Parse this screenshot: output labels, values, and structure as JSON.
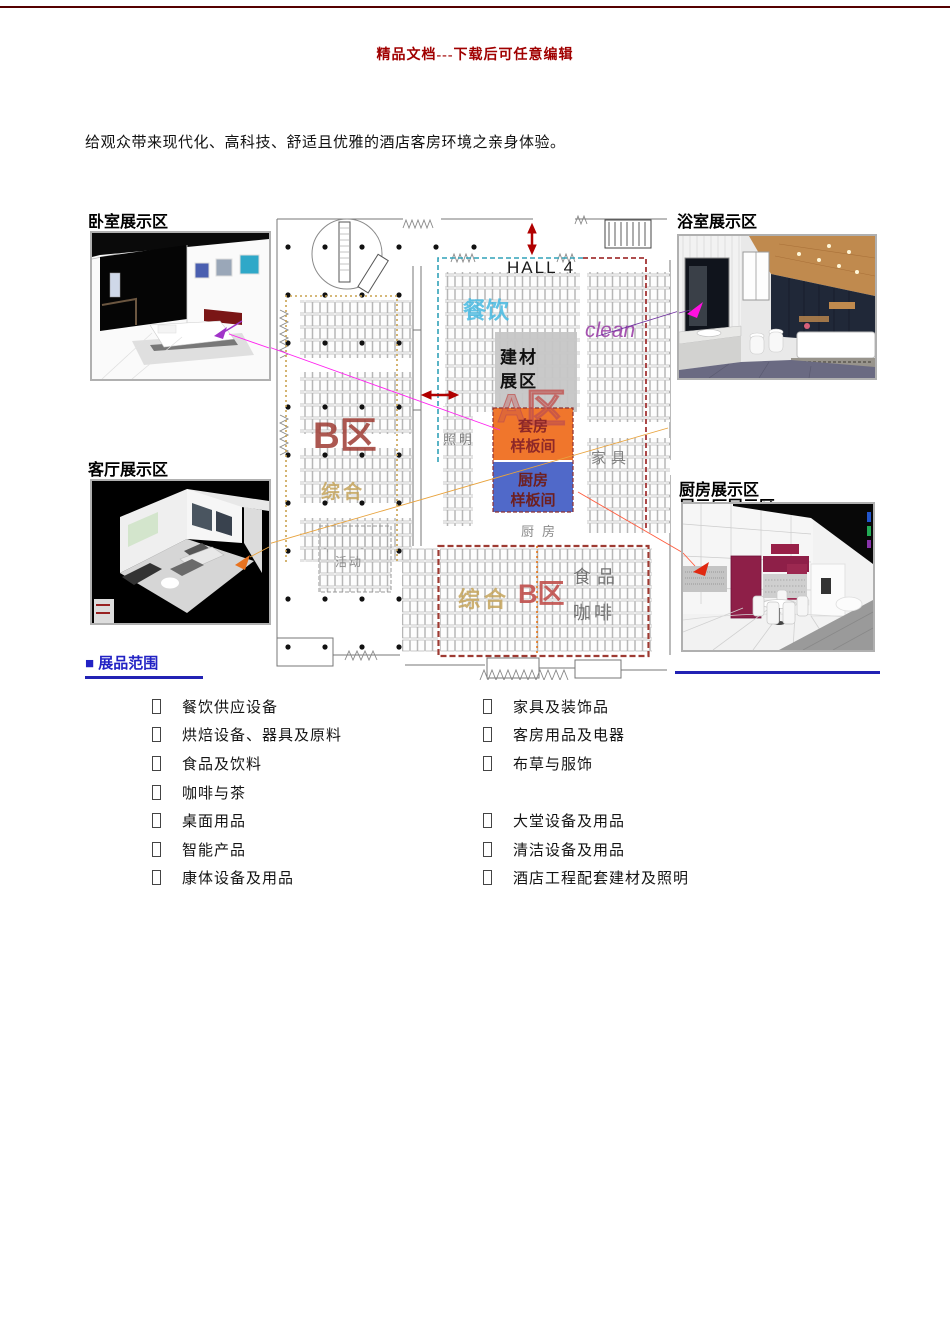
{
  "header": {
    "top_text": "精品文档---下载后可任意编辑"
  },
  "intro": {
    "text": "给观众带来现代化、高科技、舒适且优雅的酒店客房环境之亲身体验。"
  },
  "photo_areas": {
    "bedroom_label": "卧室展示区",
    "bathroom_label": "浴室展示区",
    "living_label": "客厅展示区",
    "kitchen_label": "厨房展示区",
    "kitchen_label_clipped": "展示厅展示区"
  },
  "floorplan": {
    "hall_title": "HALL 4",
    "zone_canyin": "餐饮",
    "zone_clean": "clean",
    "zone_jiancai_line1": "建材",
    "zone_jiancai_line2": "展区",
    "zone_a": "A区",
    "suite_line1": "套房",
    "suite_line2": "样板间",
    "kitchen_model_line1": "厨房",
    "kitchen_model_line2": "样板间",
    "zone_zhaoming": "照明",
    "zone_jiaju": "家具",
    "zone_chufang": "厨房",
    "zone_huodong": "活动",
    "zone_zonghe_upper": "综合",
    "zone_b_upper": "B区",
    "zone_zonghe_lower": "综合",
    "zone_b_lower": "B区",
    "zone_shipin": "食品",
    "zone_kafei": "咖啡",
    "colors": {
      "suite_box": "#F0762C",
      "kitchen_box": "#5069C9",
      "jiancai_box": "#C6C6C6",
      "zone_red": "#9E3B33",
      "canyin_blue": "#45B8E0",
      "clean_purple": "#9C41A8",
      "tan": "#C4A35A"
    }
  },
  "exhibits": {
    "section_title": "■ 展品范围",
    "left": [
      "餐饮供应设备",
      "烘焙设备、器具及原料",
      "食品及饮料",
      "咖啡与茶",
      "桌面用品",
      "智能产品",
      "康体设备及用品"
    ],
    "right": [
      "家具及装饰品",
      "客房用品及电器",
      "布草与服饰",
      "大堂设备及用品",
      "清洁设备及用品",
      "酒店工程配套建材及照明"
    ]
  }
}
